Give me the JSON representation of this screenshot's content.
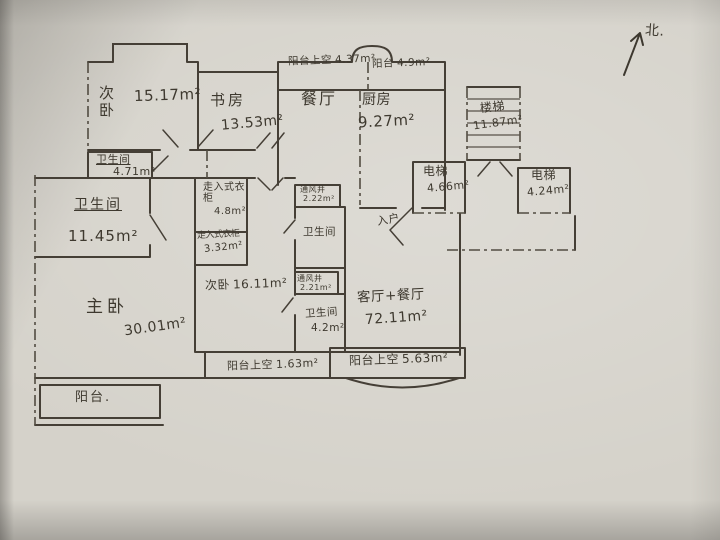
{
  "colors": {
    "ink": "#453f36",
    "paper": "#d5d2ca"
  },
  "compass": {
    "label": "北."
  },
  "rooms": {
    "bedroom2_top": {
      "name": "次卧",
      "area": "15.17m²"
    },
    "study": {
      "name": "书房",
      "area": "13.53m²"
    },
    "balcony_void_top": {
      "name": "阳台上空",
      "area": "4.37m²"
    },
    "balcony_top": {
      "name": "阳台",
      "area": "4.9m²"
    },
    "dining": {
      "name": "餐厅"
    },
    "kitchen": {
      "name": "厨房",
      "area": "9.27m²"
    },
    "stairs": {
      "name": "楼梯",
      "area": "11.87m²"
    },
    "elevator_left": {
      "name": "电梯",
      "area": "4.66m²"
    },
    "elevator_right": {
      "name": "电梯",
      "area": "4.24m²"
    },
    "bath_small": {
      "name": "卫生间",
      "area": "4.71m²"
    },
    "bath_master": {
      "name": "卫生间",
      "area": "11.45m²"
    },
    "closet_upper": {
      "name": "走入式衣柜",
      "area": "4.8m²"
    },
    "closet_lower": {
      "name": "走入式衣柜",
      "area": "3.32m²"
    },
    "shaft_upper": {
      "name": "通风井",
      "area": "2.22m²"
    },
    "bath_mid": {
      "name": "卫生间"
    },
    "shaft_lower": {
      "name": "通风井",
      "area": "2.21m²"
    },
    "bath_lower": {
      "name": "卫生间",
      "area": "4.2m²"
    },
    "bedroom2_mid": {
      "name": "次卧",
      "area": "16.11m²"
    },
    "living": {
      "name": "客厅+餐厅",
      "area": "72.11m²"
    },
    "entry": {
      "name": "入户"
    },
    "balcony_void_bl": {
      "name": "阳台上空",
      "area": "1.63m²"
    },
    "balcony_void_br": {
      "name": "阳台上空",
      "area": "5.63m²"
    },
    "master": {
      "name": "主卧",
      "area": "30.01m²"
    },
    "balcony_bottom": {
      "name": "阳台."
    }
  }
}
